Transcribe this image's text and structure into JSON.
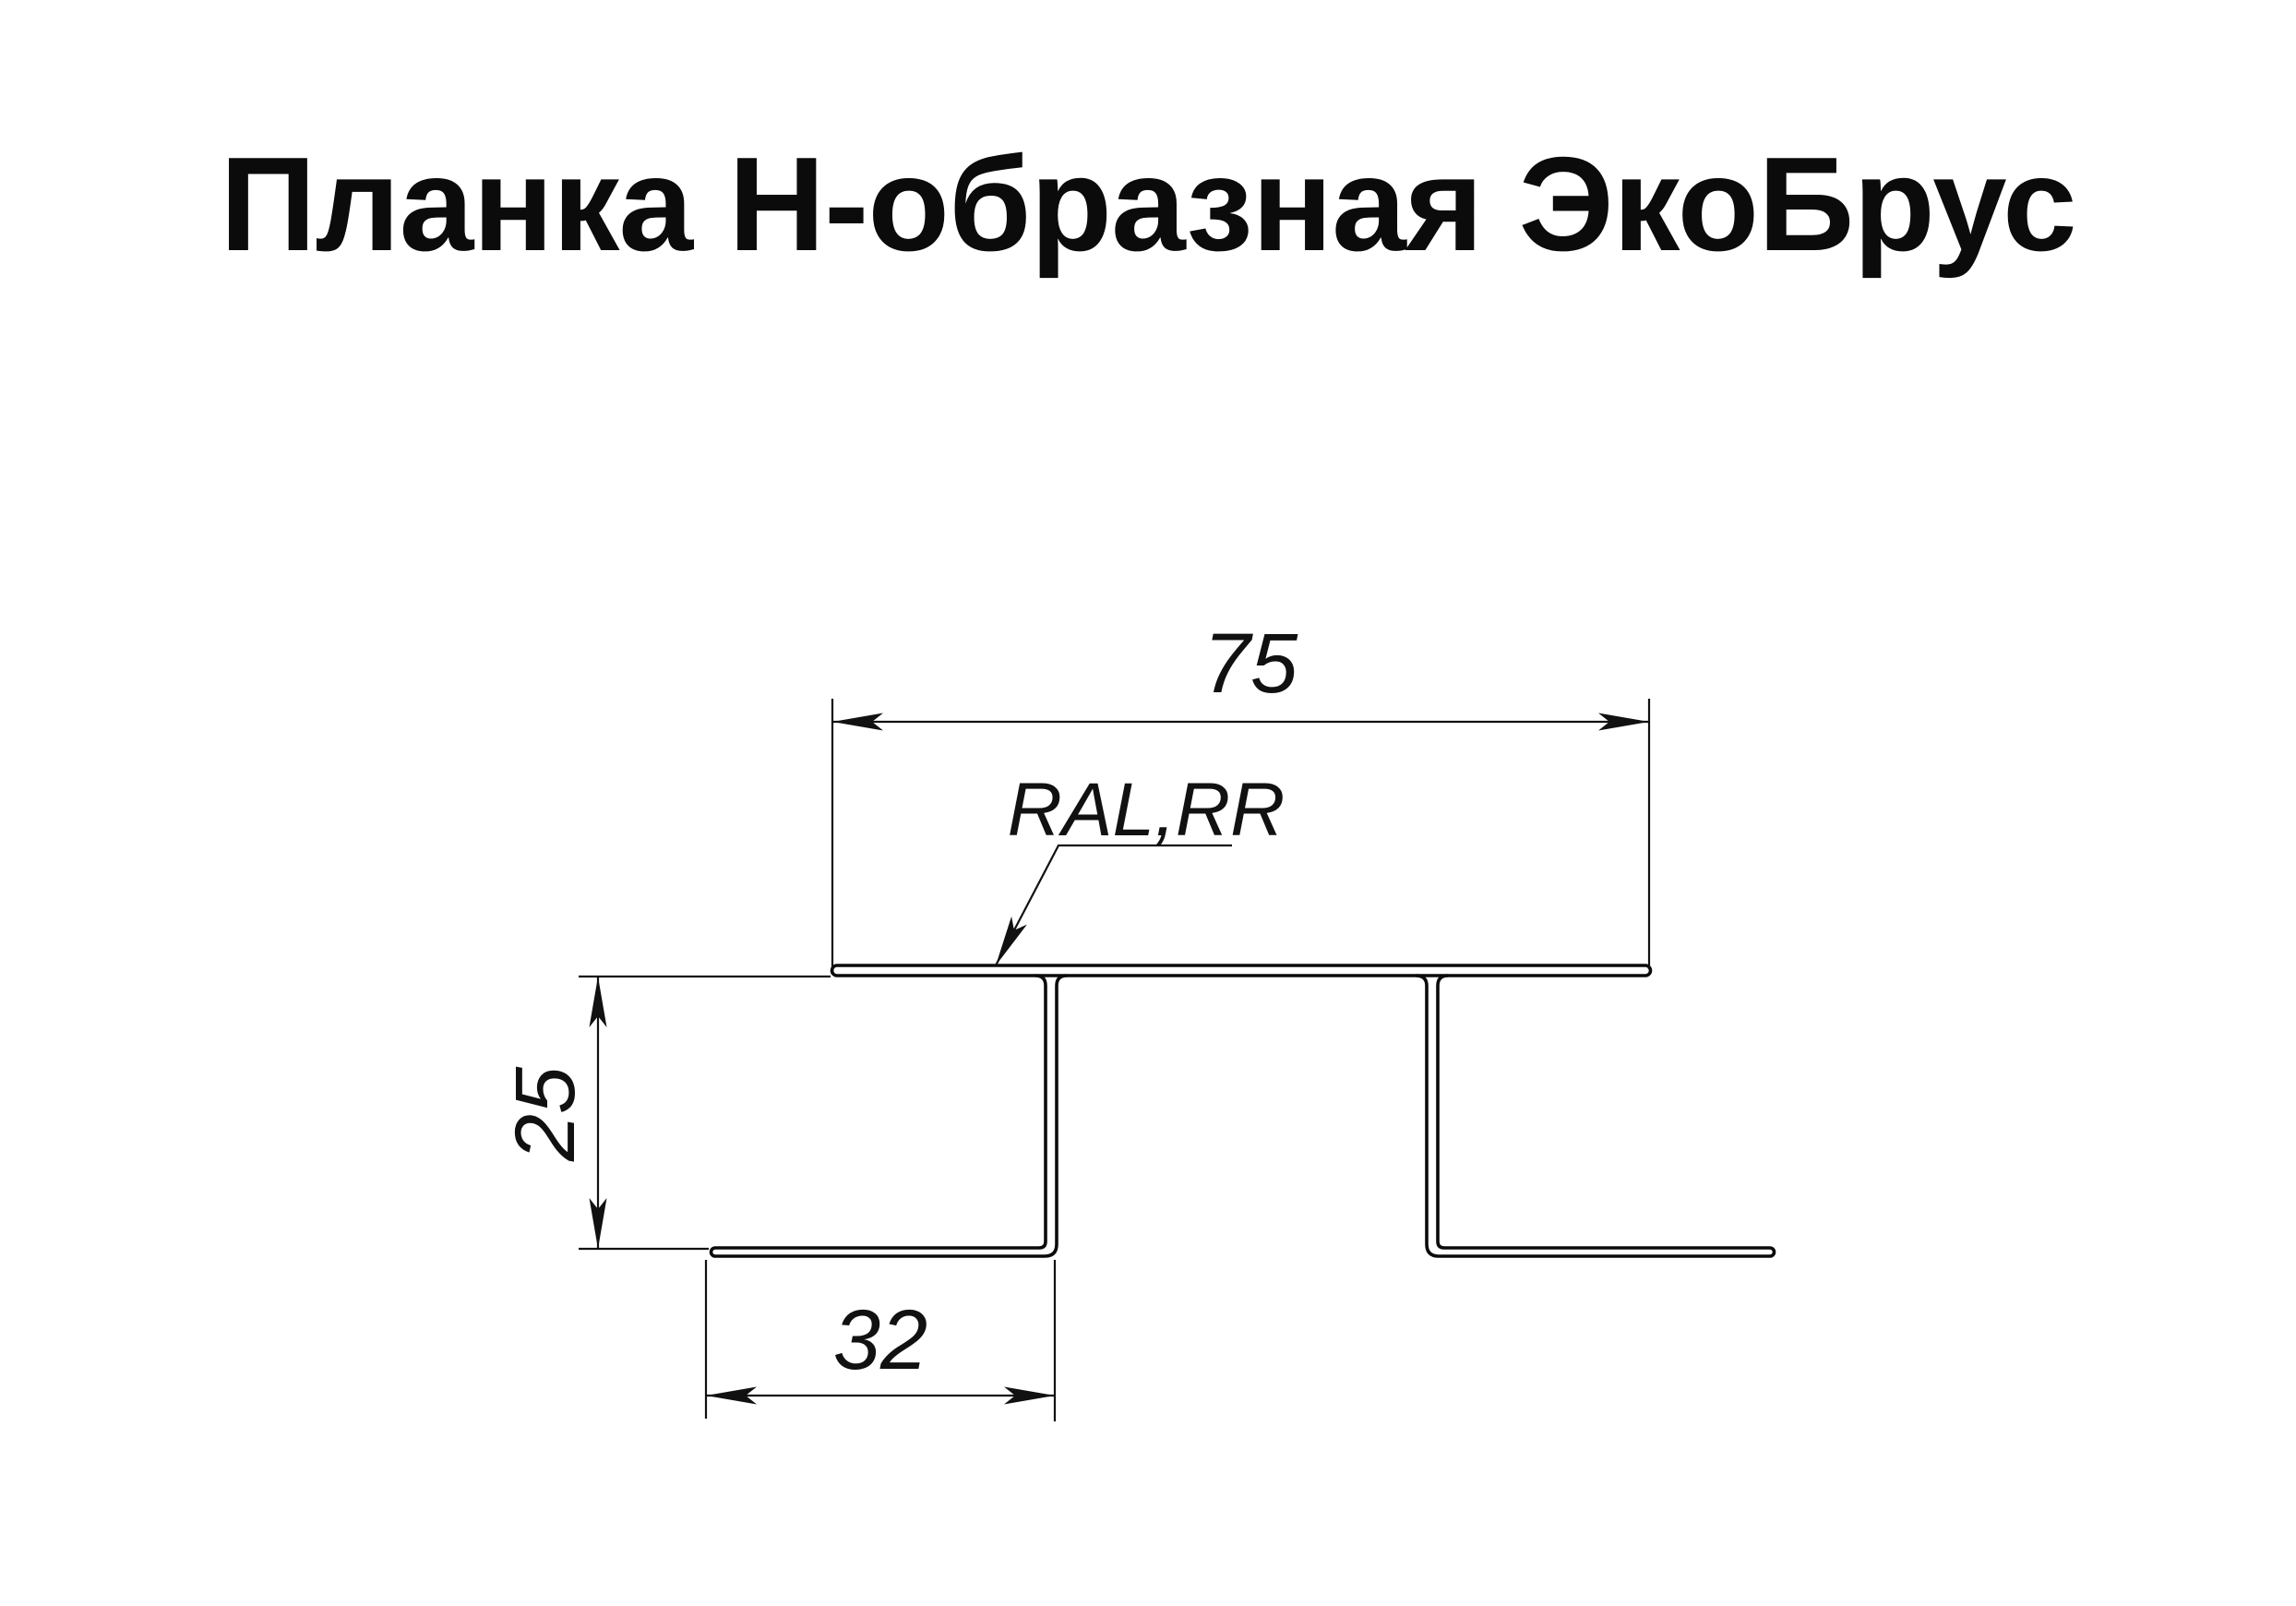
{
  "title": {
    "text": "Планка Н-образная ЭкоБрус"
  },
  "drawing": {
    "type": "technical-profile-cross-section",
    "profile_name": "H-strip for EcoBrus siding",
    "dim_top_width": {
      "value": "75"
    },
    "dim_left_height": {
      "value": "25"
    },
    "dim_bottom_flange": {
      "value": "32"
    },
    "material_label": {
      "text": "RAL,RR"
    },
    "colors": {
      "line": "#0b0b0b",
      "background": "#ffffff"
    }
  }
}
